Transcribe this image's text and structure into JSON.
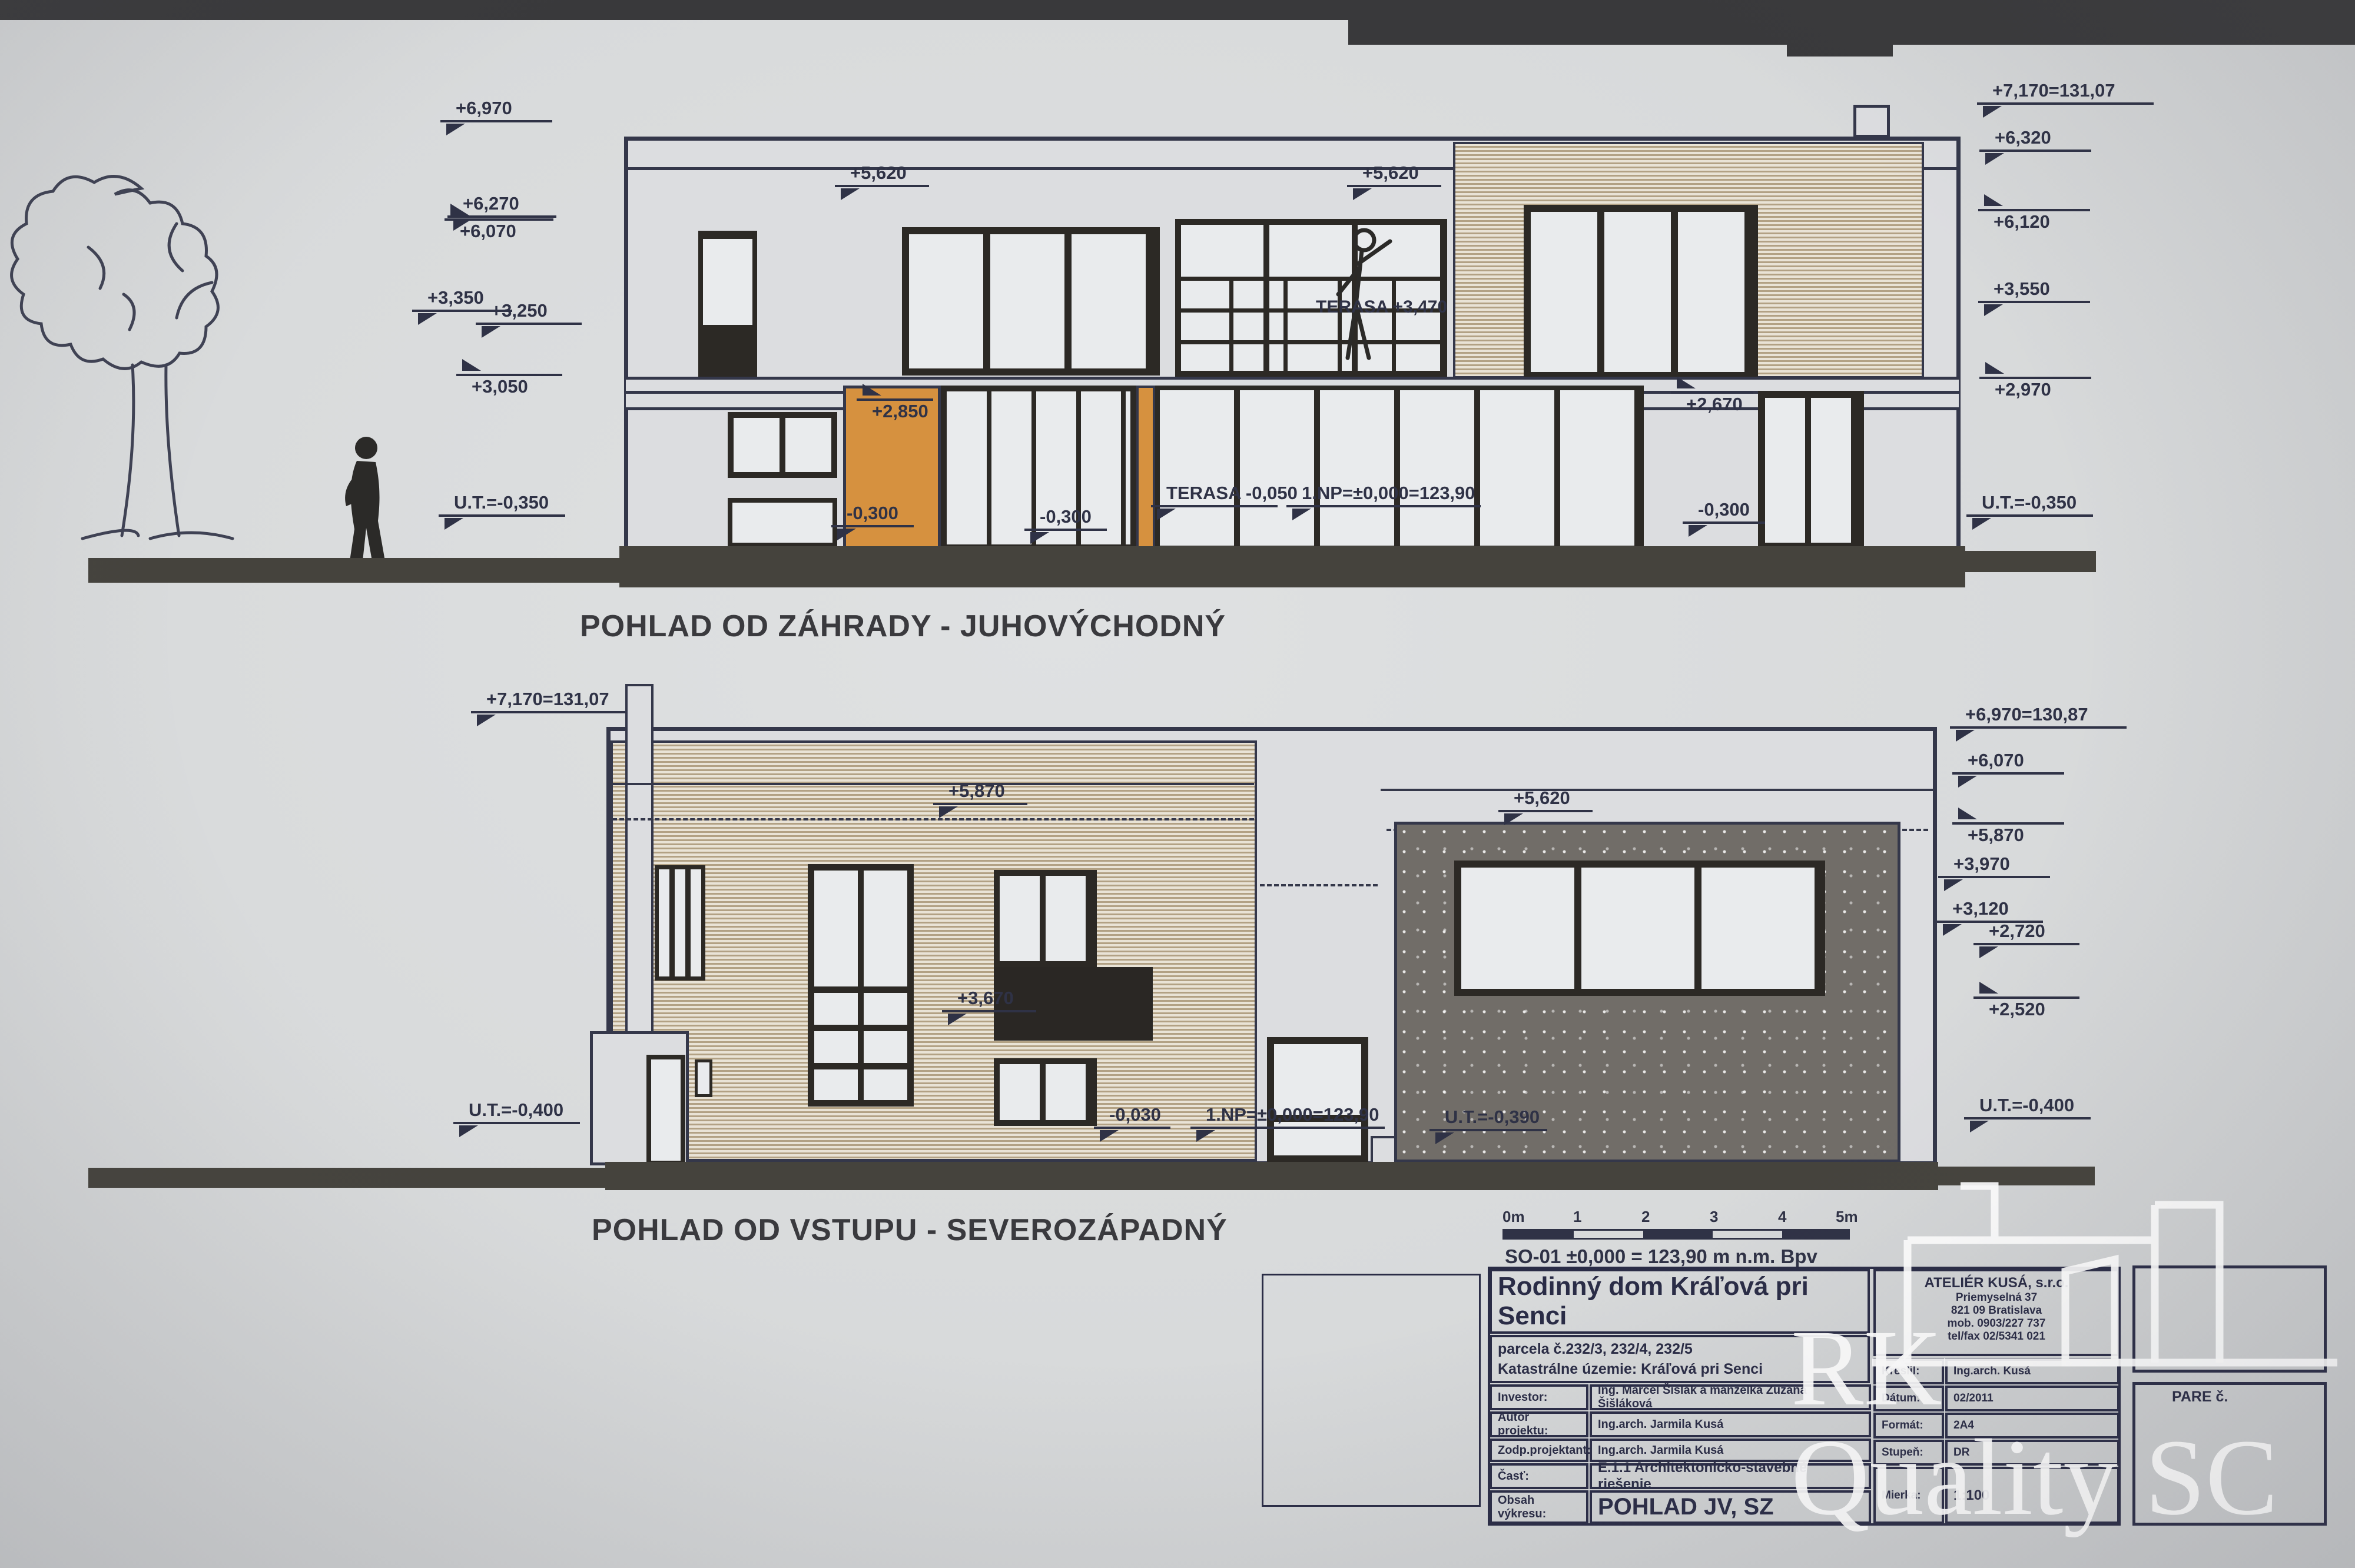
{
  "photo": {
    "top_band_color": "#39393b"
  },
  "titles": {
    "top": "POHLAD OD ZÁHRADY - JUHOVÝCHODNÝ",
    "bottom": "POHLAD OD VSTUPU - SEVEROZÁPADNÝ"
  },
  "top_view": {
    "left_markers": [
      "+6,970",
      "+6,270",
      "+6,070",
      "+3,350",
      "+3,250",
      "+3,050",
      "U.T.=-0,350"
    ],
    "right_markers": [
      "+7,170=131,07",
      "+6,320",
      "+6,120",
      "+3,550",
      "+2,970",
      "U.T.=-0,350"
    ],
    "labels": {
      "roof_left": "+5,620",
      "roof_right": "+5,620",
      "terrace_upper": "TERASA +3,470",
      "orange_top": "+2,850",
      "orange_bottom": "-0,300",
      "door_bottom": "-0,300",
      "terrace_lower": "TERASA -0,050",
      "floor_level": "1.NP=±0,000=123,90",
      "right_window": "+2,670",
      "right_bottom": "-0,300"
    }
  },
  "bottom_view": {
    "left_markers": [
      "+7,170=131,07",
      "U.T.=-0,400"
    ],
    "right_markers": [
      "+6,970=130,87",
      "+6,070",
      "+5,870",
      "+3,970",
      "+3,120",
      "+2,720",
      "+2,520",
      "U.T.=-0,400"
    ],
    "labels": {
      "roof_center": "+5,870",
      "garage_roof": "+5,620",
      "mid_window": "+3,670",
      "entry_left": "-0,030",
      "floor_level": "1.NP=±0,000=123,90",
      "garage_ground": "U.T.=-0,390"
    }
  },
  "scalebar": {
    "ticks": [
      "0m",
      "1",
      "2",
      "3",
      "4",
      "5m"
    ],
    "benchmark": "SO-01 ±0,000 = 123,90 m n.m. Bpv"
  },
  "titleblock": {
    "project_title": "Rodinný dom Kráľová pri Senci",
    "parcel": "parcela č.232/3, 232/4, 232/5",
    "cadastre": "Katastrálne územie: Kráľová pri Senci",
    "rows": [
      {
        "label": "Investor:",
        "value": "Ing. Marcel Šišlák a manželka Zuzana Šišláková"
      },
      {
        "label": "Autor projektu:",
        "value": "Ing.arch. Jarmila Kusá"
      },
      {
        "label": "Zodp.projektant:",
        "value": "Ing.arch. Jarmila Kusá"
      },
      {
        "label": "Časť:",
        "value": "E.1.1 Architektonicko-stavebné riešenie"
      },
      {
        "label": "Obsah výkresu:",
        "value": "POHLAD JV, SZ"
      }
    ],
    "office": {
      "name": "ATELIÉR KUSÁ, s.r.o.",
      "address1": "Priemyselná 37",
      "address2": "821 09 Bratislava",
      "phone1": "mob. 0903/227 737",
      "phone2": "tel/fax 02/5341 021"
    },
    "side_rows": [
      {
        "label": "Kreslil:",
        "value": "Ing.arch. Kusá"
      },
      {
        "label": "Dátum:",
        "value": "02/2011"
      },
      {
        "label": "Formát:",
        "value": "2A4"
      },
      {
        "label": "Stupeň:",
        "value": "DR"
      },
      {
        "label": "Mierka:",
        "value": "1:100"
      }
    ],
    "pare": "PARE č."
  },
  "watermark": {
    "line1": "RK",
    "line2": "Quality SC"
  }
}
